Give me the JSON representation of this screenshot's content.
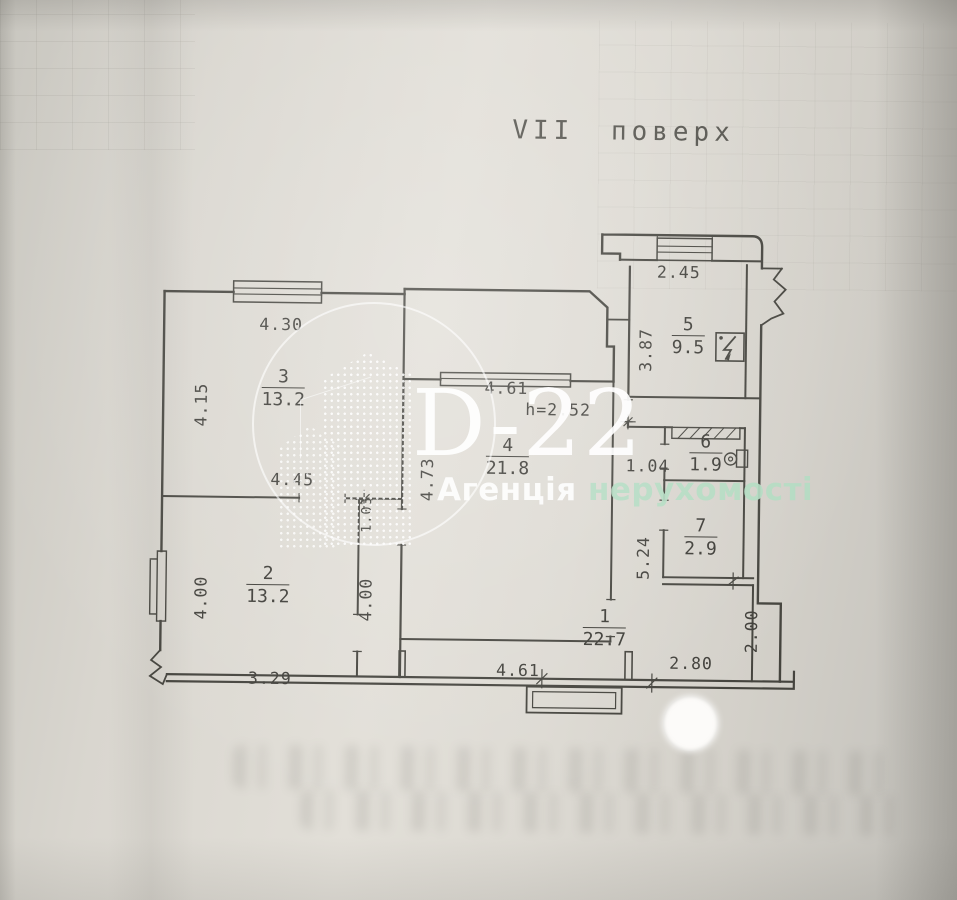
{
  "page": {
    "title": "VII  поверх"
  },
  "watermark": {
    "logo": "D-22",
    "agency_1": "Агенція",
    "agency_2": "нерухомості"
  },
  "plan": {
    "height_note": "h=2.52",
    "rooms": [
      {
        "num": "1",
        "area": "22.7"
      },
      {
        "num": "2",
        "area": "13.2"
      },
      {
        "num": "3",
        "area": "13.2"
      },
      {
        "num": "4",
        "area": "21.8"
      },
      {
        "num": "5",
        "area": "9.5"
      },
      {
        "num": "6",
        "area": "1.9"
      },
      {
        "num": "7",
        "area": "2.9"
      }
    ],
    "dimensions": {
      "room3_top": "4.30",
      "room3_left": "4.15",
      "room3_bottom": "4.45",
      "corridor_width": "1.03",
      "room4_top": "4.61",
      "room4_left": "4.73",
      "kitchen_top": "2.45",
      "kitchen_left": "3.87",
      "vestibule": "1.04",
      "hall_right": "5.24",
      "room2_left": "4.00",
      "room2_right": "4.00",
      "room2_bottom": "3.29",
      "hall_bottom": "4.61",
      "entry_bottom": "2.80",
      "entry_right": "2.00"
    },
    "colors": {
      "ink": "#45443e",
      "paper": "#dddad3"
    }
  }
}
